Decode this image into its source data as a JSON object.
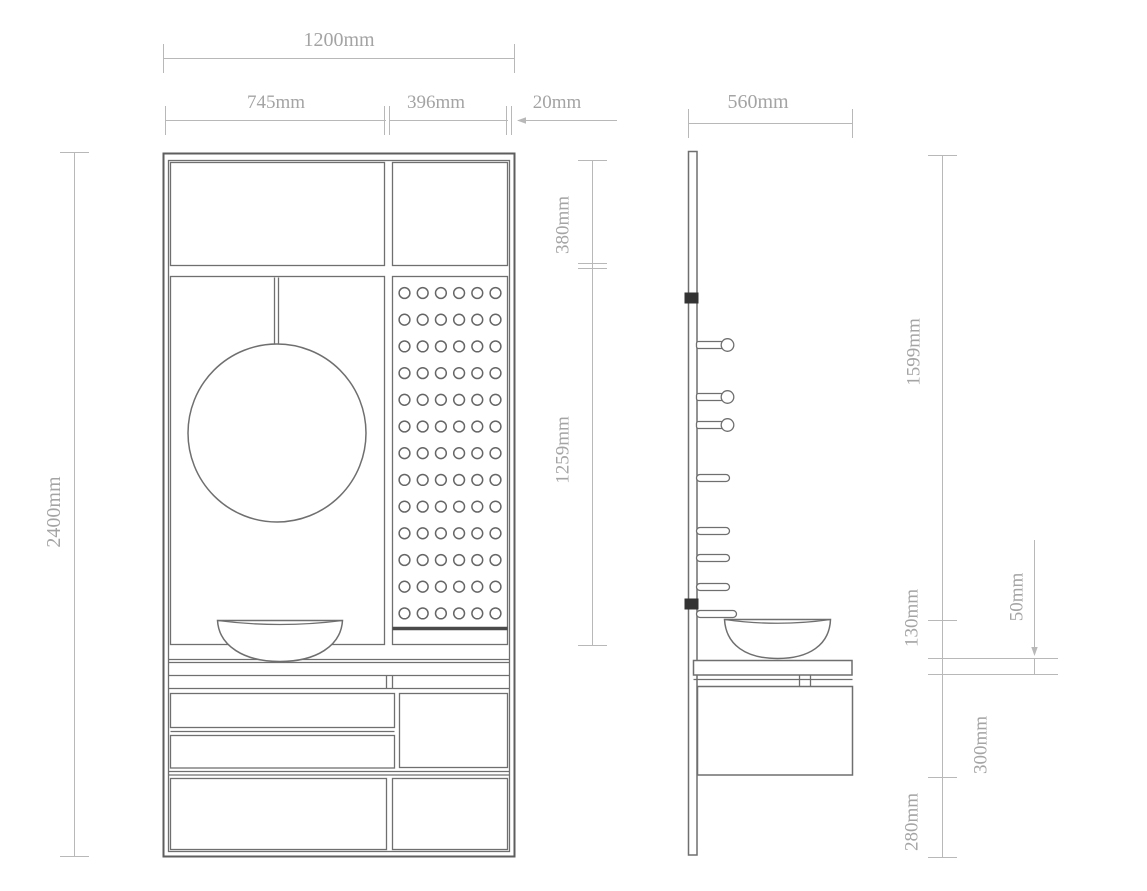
{
  "colors": {
    "background": "#ffffff",
    "drawing_line": "#6f6f6f",
    "dimension_line": "#b8b8b8",
    "dimension_text": "#a4a4a4",
    "clip_accent": "#333333"
  },
  "front_view": {
    "pegboard": {
      "rows": 13,
      "cols": 6
    },
    "dimensions": {
      "overall_width": "1200mm",
      "mirror_section_width": "745mm",
      "pegboard_section_width": "396mm",
      "side_gap": "20mm",
      "overall_height": "2400mm",
      "top_cabinet_height": "380mm",
      "open_section_height": "1259mm"
    }
  },
  "side_view": {
    "hooks": {
      "knob_hooks": 3,
      "flat_hooks": 5
    },
    "dimensions": {
      "depth": "560mm",
      "upper_panel_height": "1599mm",
      "basin_height": "130mm",
      "countertop_thickness": "50mm",
      "cabinet_height": "300mm",
      "floor_clearance": "280mm"
    }
  }
}
